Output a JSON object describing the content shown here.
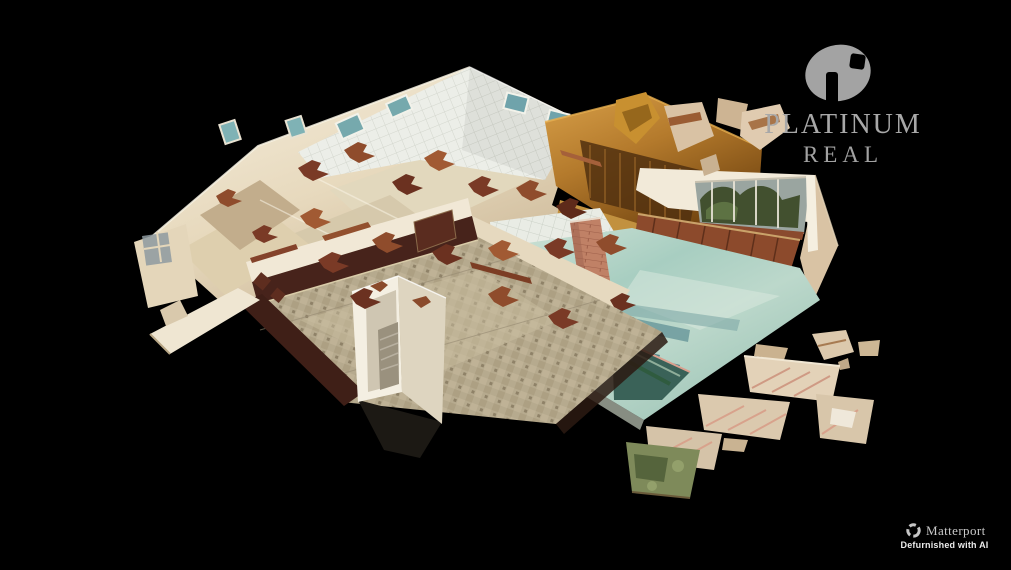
{
  "brand": {
    "line1": "PLATINUM",
    "line2": "REAL",
    "text_color": "#a8a8a8",
    "mark_color": "#a3a3a3"
  },
  "watermark": {
    "name": "Matterport",
    "tagline": "Defurnished with AI",
    "name_color": "#c9c9c9",
    "tagline_color": "#ececec"
  },
  "icons": {
    "brand_mark": "ellipse-with-square-and-bar-cutouts",
    "matterport_mark": "segmented-ring"
  },
  "scene": {
    "background": "#000000",
    "palette": {
      "wall_cream": "#e9dcc2",
      "wall_bright": "#f6efdf",
      "wall_shadow": "#c3ad8d",
      "tile_white": "#eceee8",
      "wood_light": "#d79f48",
      "wood_dark": "#70430f",
      "debris_brown": "#7a3a26",
      "pool_teal": "#a8cec1",
      "pool_streak": "#35707b",
      "floor_mosaic": "#b6aa8e",
      "wainscot_brown": "#47231b",
      "brick": "#c08166",
      "window_teal": "#76a9ad",
      "foliage_green": "#55643c"
    }
  }
}
